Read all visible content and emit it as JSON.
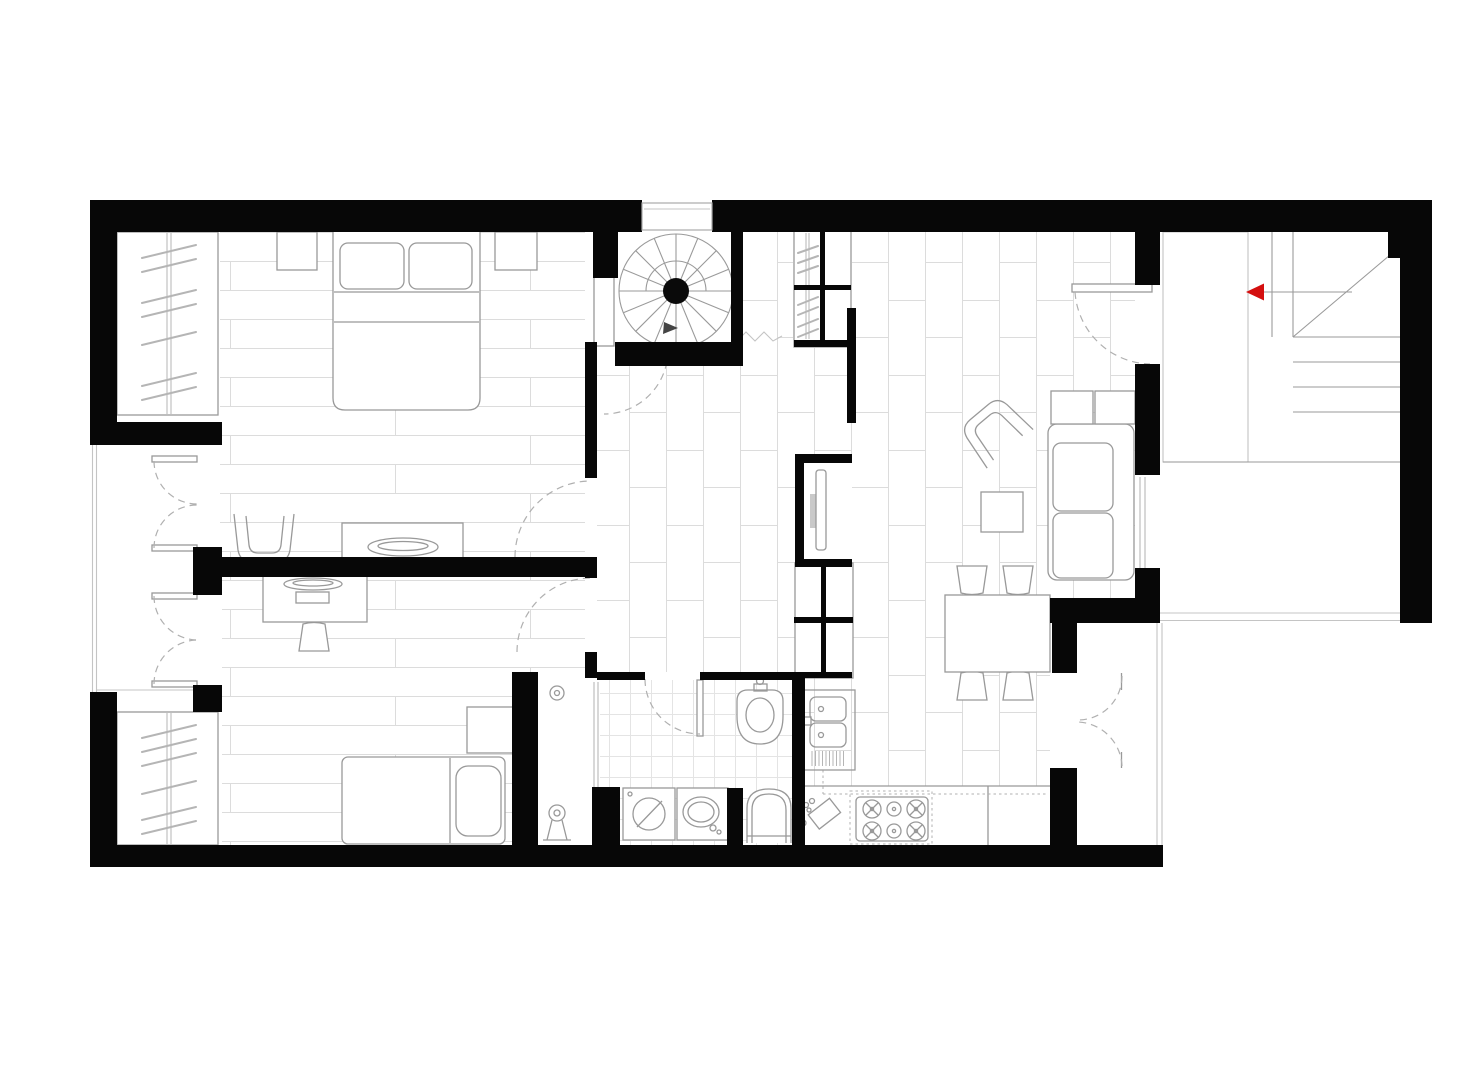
{
  "meta": {
    "title": "apartment-floor-plan",
    "type": "architectural-plan",
    "text_labels": []
  },
  "colors": {
    "bg": "#ffffff",
    "wall": "#070707",
    "line": "#999999",
    "arch": "#c4c4c4",
    "dash": "#b0b0b0",
    "hanger": "#b5b5b5",
    "stairline": "#9a9a9a",
    "floor": "#dcdcdc",
    "tile": "#e4e4e4",
    "tvfill": "#c9c9c9",
    "accent": "#d40f0f"
  },
  "rooms": [
    {
      "name": "bedroom-main",
      "floor": "horizontal-planks"
    },
    {
      "name": "bedroom-office",
      "floor": "horizontal-planks"
    },
    {
      "name": "hall",
      "floor": "vertical-planks"
    },
    {
      "name": "living-room",
      "floor": "vertical-planks"
    },
    {
      "name": "kitchen",
      "floor": "vertical-planks"
    },
    {
      "name": "bathroom",
      "floor": "square-tiles"
    },
    {
      "name": "shower-room",
      "floor": "none"
    },
    {
      "name": "balcony",
      "floor": "none"
    },
    {
      "name": "stair-terrace",
      "floor": "none"
    },
    {
      "name": "spiral-stair-lobby",
      "floor": "none"
    }
  ],
  "furniture": {
    "bedroom_main": [
      "wardrobe-with-hangers",
      "double-bed",
      "pillow-left",
      "pillow-right",
      "nightstand-left",
      "nightstand-right",
      "tub-chair",
      "dresser-with-tray"
    ],
    "bedroom_office": [
      "desk",
      "laptop",
      "desk-chair",
      "wardrobe-with-hangers",
      "single-bed",
      "pillow",
      "nightstand"
    ],
    "hall": [
      "spiral-staircase",
      "hall-closet-with-hangers",
      "tv-partition-wall",
      "television",
      "storage-cabinet"
    ],
    "living_room": [
      "sofa-two-seat",
      "sideboard",
      "armchair-rotated",
      "coffee-table",
      "dining-table",
      "dining-chair-1",
      "dining-chair-2",
      "dining-chair-3",
      "dining-chair-4"
    ],
    "kitchen": [
      "double-sink-with-drainboard",
      "gas-stove-six-burner",
      "cutting-board",
      "countertop",
      "overhead-cabinets-dashed"
    ],
    "bathroom": [
      "bidet",
      "washing-machine",
      "washbasin",
      "toilet",
      "shower-head",
      "shower-column"
    ]
  },
  "doors": [
    "entry-recess-top",
    "spiral-stair-door",
    "bedroom-main-door",
    "bedroom-office-door",
    "bathroom-door",
    "living-room-side-door",
    "balcony-french-door-upper",
    "balcony-french-door-lower",
    "kitchen-french-door"
  ],
  "stairs": {
    "spiral": {
      "location": "top-center",
      "direction_arrow": true
    },
    "straight": {
      "location": "top-right",
      "treads_upper": 3,
      "treads_lower": 4,
      "break_line": "diagonal",
      "direction_arrow_color_key": "accent",
      "arrow_points": "left"
    }
  },
  "windows": [
    "living-room-right-window",
    "balcony-glazing",
    "terrace-edge-lines"
  ]
}
